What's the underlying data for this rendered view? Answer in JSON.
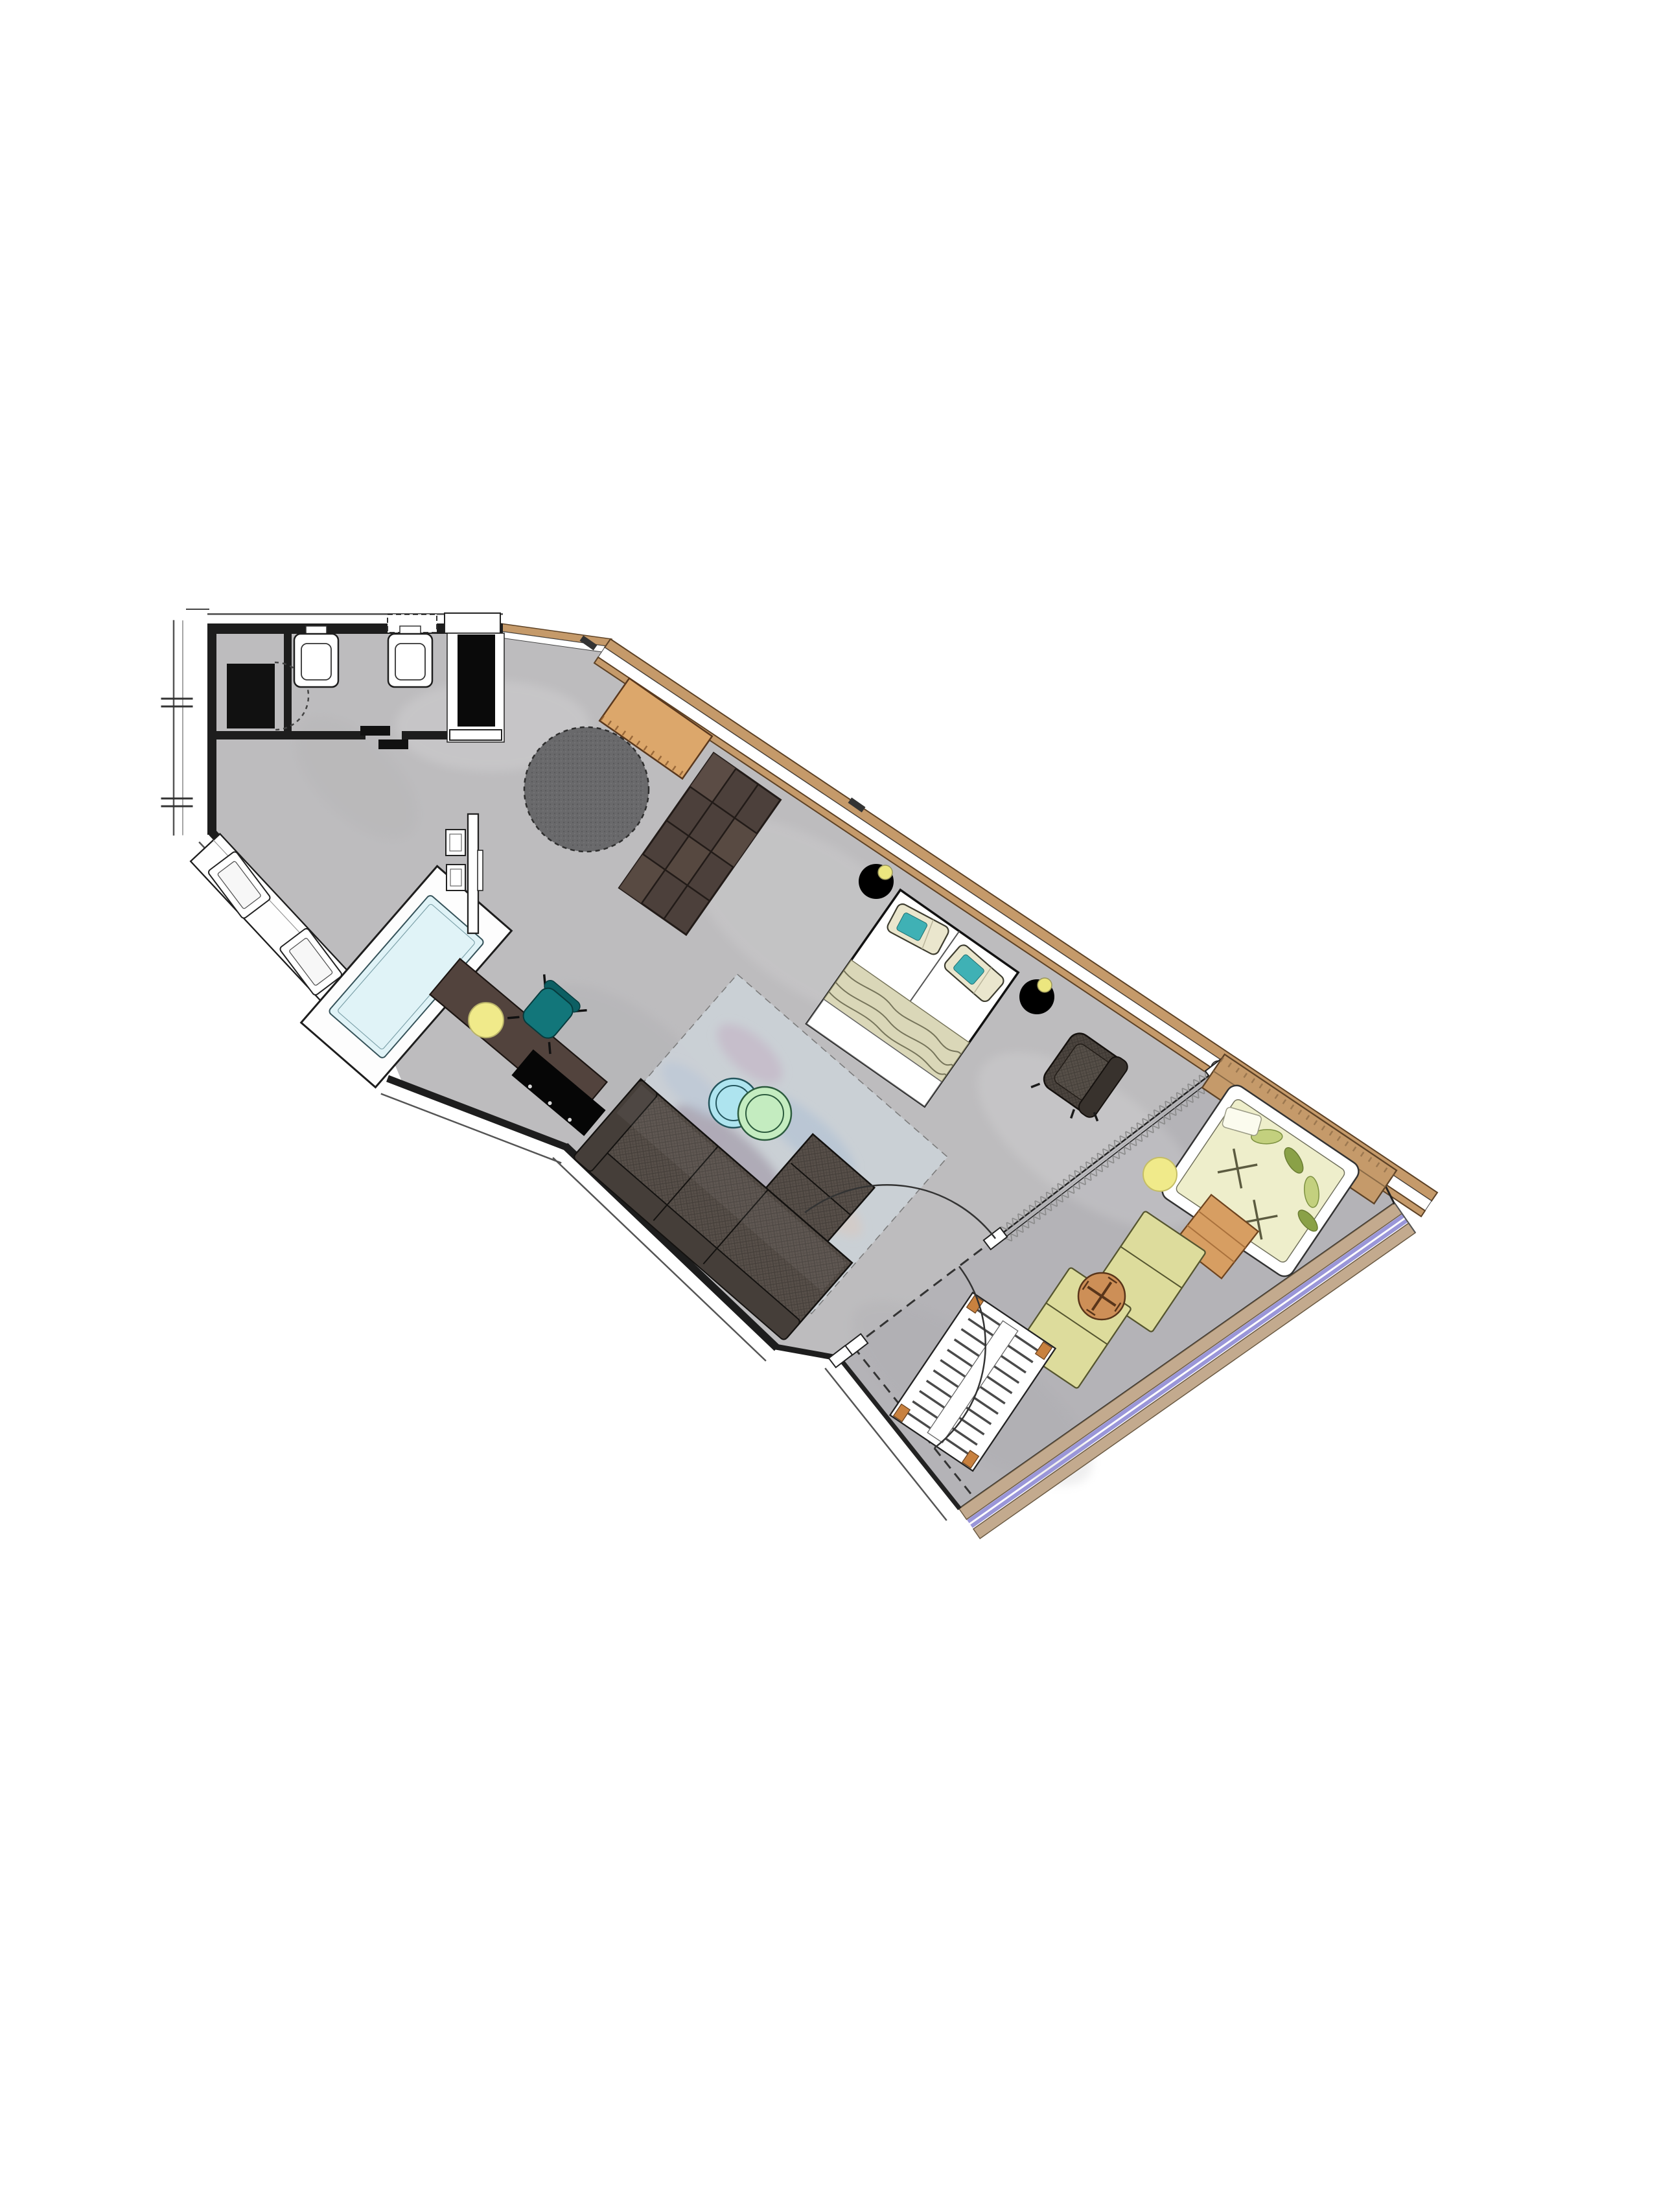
{
  "meta": {
    "type": "architectural-floor-plan",
    "description": "Top-down rendered floor plan of a diagonal studio hotel suite with entry, WC, open bathroom with freestanding tub, living/sleeping area and large terrace with loungers",
    "orientation_deg": 35
  },
  "colors": {
    "background": "#ffffff",
    "floor": "#bdbcbe",
    "terrace_floor": "#a9a9af",
    "wall": "#1d1d1d",
    "outline_thin": "#555555",
    "wood": "#c59a6a",
    "wood_edge": "#5d4226",
    "railing": "#9a96d8",
    "railing_band": "#c3aa8e",
    "rug_round": "#69696b",
    "rug_watercolor": "#ccd2d8",
    "sofa": "#574f49",
    "sofa_dark": "#453e39",
    "armchair": "#4b443e",
    "cabinet": "#4c403b",
    "window_desk": "#dca76b",
    "console": "#52433d",
    "tv": "#060606",
    "wardrobe": "#0a0a0a",
    "bed": "#ffffff",
    "pillow_teal": "#3fb1b5",
    "throw": "#dad7b8",
    "nightstand": "#000000",
    "lamp": "#ece67f",
    "table_blue": "#aee4ef",
    "table_green": "#c4ecc0",
    "pouf": "#f0ea8a",
    "chair_teal": "#12767a",
    "bathtub": "#e0f3f7",
    "fixture": "#ffffff",
    "lounger": "#dddc9c",
    "daybed": "#eeeecb",
    "bistro": "#cd8f57",
    "side_table": "#d79e62",
    "leaf_light": "#c3d07e",
    "leaf_dark": "#8aa147",
    "curtain_line": "#8a8a8a"
  },
  "plan": {
    "rooms": [
      {
        "name": "entry-hall"
      },
      {
        "name": "wc"
      },
      {
        "name": "open-bathroom"
      },
      {
        "name": "living-sleeping-area"
      },
      {
        "name": "terrace"
      }
    ],
    "furniture": [
      {
        "name": "entrance-mat",
        "color": "#111111"
      },
      {
        "name": "wc-toilet",
        "color": "#ffffff"
      },
      {
        "name": "wc-bidet",
        "color": "#ffffff"
      },
      {
        "name": "wardrobe",
        "color": "#0a0a0a"
      },
      {
        "name": "vanity-counter-two-sinks",
        "color": "#ffffff"
      },
      {
        "name": "freestanding-bathtub",
        "color": "#e0f3f7"
      },
      {
        "name": "partition-panel",
        "color": "#ffffff"
      },
      {
        "name": "side-stools",
        "color": "#ffffff"
      },
      {
        "name": "console-desk",
        "color": "#52433d"
      },
      {
        "name": "tv",
        "color": "#060606"
      },
      {
        "name": "desk-chair",
        "color": "#12767a"
      },
      {
        "name": "pouf-living",
        "color": "#f0ea8a"
      },
      {
        "name": "round-rug",
        "color": "#69696b"
      },
      {
        "name": "window-desk",
        "color": "#dca76b"
      },
      {
        "name": "storage-cabinet",
        "color": "#4c403b"
      },
      {
        "name": "double-bed",
        "color": "#ffffff"
      },
      {
        "name": "nightstand-left",
        "color": "#000000"
      },
      {
        "name": "nightstand-right",
        "color": "#000000"
      },
      {
        "name": "bedside-lamps",
        "color": "#ece67f"
      },
      {
        "name": "armchair",
        "color": "#4b443e"
      },
      {
        "name": "corner-sofa",
        "color": "#574f49"
      },
      {
        "name": "watercolor-rug",
        "color": "#ccd2d8"
      },
      {
        "name": "coffee-table-blue",
        "color": "#aee4ef"
      },
      {
        "name": "coffee-table-green",
        "color": "#c4ecc0"
      },
      {
        "name": "curtain",
        "color": "#ffffff"
      },
      {
        "name": "sliding-door-symbol",
        "color": "#111111"
      },
      {
        "name": "door-swings",
        "color": "#333333"
      },
      {
        "name": "terrace-bench",
        "color": "#c59a6a"
      },
      {
        "name": "daybed",
        "color": "#eeeecb"
      },
      {
        "name": "side-table-square",
        "color": "#d79e62"
      },
      {
        "name": "bistro-table",
        "color": "#cd8f57"
      },
      {
        "name": "sun-lounger-1",
        "color": "#dddc9c"
      },
      {
        "name": "sun-lounger-2",
        "color": "#dddc9c"
      },
      {
        "name": "pouf-terrace",
        "color": "#f0ea8a"
      },
      {
        "name": "slatted-lounger",
        "color": "#ffffff"
      },
      {
        "name": "glass-railing",
        "color": "#9a96d8"
      }
    ]
  }
}
